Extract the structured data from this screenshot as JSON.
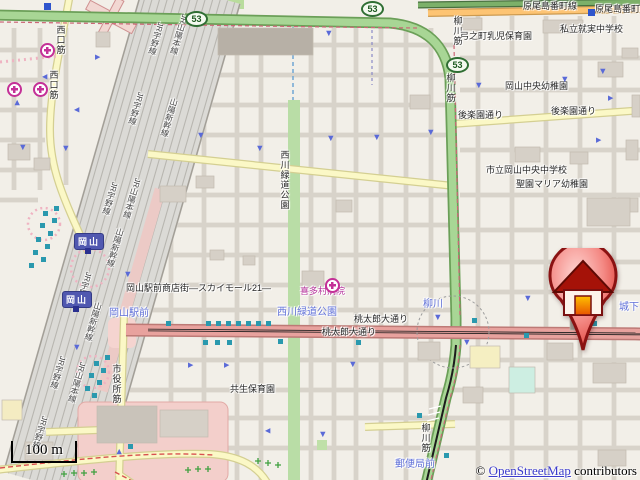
{
  "map": {
    "attribution": {
      "copyright": "© ",
      "link_text": "OpenStreetMap",
      "suffix": " contributors"
    },
    "scale_bar": {
      "label": "100 m"
    },
    "house_marker": {
      "x": 583,
      "y": 350,
      "icon": "house-pin-icon"
    },
    "colors": {
      "trunk_road": "#a8d695",
      "primary_road": "#e8a29e",
      "secondary_road": "#fdc473",
      "tertiary_road": "#fbf8c6",
      "park": "#b9dda6",
      "railway": "#dbdad6",
      "signal_icon": "#2a99ae",
      "oneway_arrow": "#5a6ad8",
      "tram_stop_text": "#6070d8",
      "hospital_icon": "#c43097",
      "link_text": "#3c3ccc",
      "marker_red": "#e04040"
    },
    "route_shields": [
      {
        "t": "53",
        "x": 185,
        "y": 11
      },
      {
        "t": "53",
        "x": 361,
        "y": 1
      },
      {
        "t": "53",
        "x": 446,
        "y": 57
      }
    ],
    "station_labels": [
      {
        "t": "岡山",
        "x": 74,
        "y": 233
      },
      {
        "t": "岡山",
        "x": 62,
        "y": 291
      }
    ],
    "road_labels": [
      {
        "t": "原尾島番町線",
        "x": 523,
        "y": 2
      },
      {
        "t": "原尾島番町線",
        "x": 595,
        "y": 5
      },
      {
        "t": "後楽園通り",
        "x": 458,
        "y": 111
      },
      {
        "t": "後楽園通り",
        "x": 551,
        "y": 107
      },
      {
        "t": "桃太郎大通り",
        "x": 354,
        "y": 315
      },
      {
        "t": "桃太郎大通り",
        "x": 322,
        "y": 328
      },
      {
        "t": "岡山駅前商店街―スカイモール21―",
        "x": 126,
        "y": 284
      },
      {
        "t": "西口筋",
        "x": 55,
        "y": 25,
        "v": 1
      },
      {
        "t": "西口筋",
        "x": 48,
        "y": 70,
        "v": 1
      },
      {
        "t": "柳川筋",
        "x": 452,
        "y": 16,
        "v": 1
      },
      {
        "t": "柳川筋",
        "x": 445,
        "y": 73,
        "v": 1
      },
      {
        "t": "柳川筋",
        "x": 420,
        "y": 423,
        "v": 1
      },
      {
        "t": "市役所筋",
        "x": 111,
        "y": 364,
        "v": 1
      },
      {
        "t": "西川緑道公園",
        "x": 279,
        "y": 150,
        "v": 1
      }
    ],
    "place_labels": [
      {
        "t": "私立就実中学校",
        "x": 560,
        "y": 25
      },
      {
        "t": "弓之町乳児保育園",
        "x": 460,
        "y": 32
      },
      {
        "t": "岡山中央幼稚園",
        "x": 505,
        "y": 82
      },
      {
        "t": "市立岡山中央中学校",
        "x": 486,
        "y": 166
      },
      {
        "t": "聖園マリア幼稚園",
        "x": 516,
        "y": 180
      },
      {
        "t": "共生保育園",
        "x": 230,
        "y": 385
      },
      {
        "t": "喜多村病院",
        "x": 300,
        "y": 287,
        "c": "#b5309b"
      }
    ],
    "tram_stops": [
      {
        "t": "岡山駅前",
        "x": 109,
        "y": 309
      },
      {
        "t": "柳川",
        "x": 423,
        "y": 300
      },
      {
        "t": "城下",
        "x": 619,
        "y": 303
      },
      {
        "t": "郵便局前",
        "x": 395,
        "y": 460
      },
      {
        "t": "西川緑道公園",
        "x": 277,
        "y": 308
      }
    ],
    "railway_labels": [
      {
        "t": "JR宇野線",
        "x": 156,
        "y": 22
      },
      {
        "t": "JR山陽本線",
        "x": 180,
        "y": 14
      },
      {
        "t": "JR宇野線",
        "x": 136,
        "y": 92
      },
      {
        "t": "山陽新幹線",
        "x": 170,
        "y": 98
      },
      {
        "t": "JR宇野線",
        "x": 110,
        "y": 182
      },
      {
        "t": "JR山陽本線",
        "x": 133,
        "y": 178
      },
      {
        "t": "山陽新幹線",
        "x": 116,
        "y": 228
      },
      {
        "t": "JR宇野線",
        "x": 84,
        "y": 272
      },
      {
        "t": "山陽新幹線",
        "x": 94,
        "y": 302
      },
      {
        "t": "JR宇野線",
        "x": 58,
        "y": 356
      },
      {
        "t": "JR山陽本線",
        "x": 78,
        "y": 362
      },
      {
        "t": "JR宇野線",
        "x": 40,
        "y": 416
      }
    ],
    "hospitals": [
      [
        40,
        43
      ],
      [
        7,
        82
      ],
      [
        33,
        82
      ],
      [
        325,
        278
      ]
    ],
    "blue_squares": [
      [
        44,
        3
      ],
      [
        588,
        9
      ]
    ],
    "signals": [
      [
        54,
        206
      ],
      [
        43,
        211
      ],
      [
        52,
        218
      ],
      [
        40,
        223
      ],
      [
        48,
        231
      ],
      [
        36,
        237
      ],
      [
        45,
        244
      ],
      [
        33,
        250
      ],
      [
        41,
        257
      ],
      [
        29,
        263
      ],
      [
        105,
        355
      ],
      [
        94,
        361
      ],
      [
        101,
        368
      ],
      [
        89,
        373
      ],
      [
        97,
        380
      ],
      [
        85,
        386
      ],
      [
        92,
        393
      ],
      [
        166,
        321
      ],
      [
        206,
        321
      ],
      [
        216,
        321
      ],
      [
        226,
        321
      ],
      [
        236,
        321
      ],
      [
        246,
        321
      ],
      [
        256,
        321
      ],
      [
        266,
        321
      ],
      [
        203,
        340
      ],
      [
        215,
        340
      ],
      [
        227,
        340
      ],
      [
        278,
        339
      ],
      [
        128,
        444
      ],
      [
        356,
        340
      ],
      [
        524,
        333
      ],
      [
        592,
        321
      ],
      [
        417,
        413
      ],
      [
        444,
        453
      ],
      [
        472,
        318
      ]
    ],
    "arrows": [
      [
        95,
        54,
        0
      ],
      [
        42,
        73,
        180
      ],
      [
        74,
        106,
        180
      ],
      [
        15,
        99,
        270
      ],
      [
        20,
        144,
        90
      ],
      [
        63,
        145,
        90
      ],
      [
        198,
        132,
        90
      ],
      [
        257,
        145,
        90
      ],
      [
        326,
        30,
        90
      ],
      [
        328,
        135,
        90
      ],
      [
        374,
        134,
        90
      ],
      [
        596,
        137,
        0
      ],
      [
        476,
        82,
        90
      ],
      [
        562,
        76,
        90
      ],
      [
        428,
        129,
        90
      ],
      [
        188,
        362,
        0
      ],
      [
        265,
        427,
        180
      ],
      [
        117,
        448,
        270
      ],
      [
        350,
        361,
        90
      ],
      [
        320,
        431,
        90
      ],
      [
        525,
        295,
        90
      ],
      [
        435,
        314,
        90
      ],
      [
        464,
        339,
        90
      ],
      [
        74,
        344,
        90
      ],
      [
        125,
        271,
        90
      ],
      [
        224,
        362,
        0
      ],
      [
        600,
        68,
        90
      ],
      [
        608,
        95,
        0
      ]
    ]
  }
}
